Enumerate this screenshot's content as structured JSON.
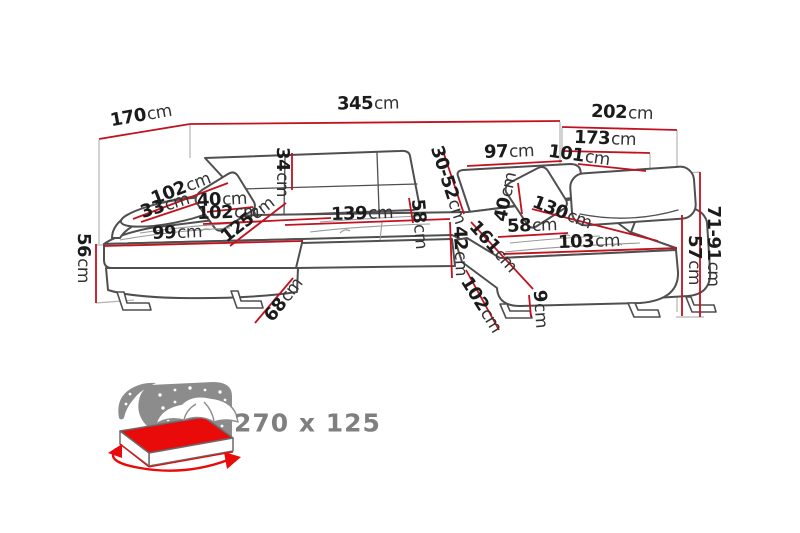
{
  "diagram": {
    "type": "corner-sofa-dimension-drawing",
    "unit": "cm",
    "dims": {
      "w170": {
        "num": "170",
        "suffix": "cm"
      },
      "w345": {
        "num": "345",
        "suffix": "cm"
      },
      "w202": {
        "num": "202",
        "suffix": "cm"
      },
      "w173": {
        "num": "173",
        "suffix": "cm"
      },
      "w97": {
        "num": "97",
        "suffix": "cm"
      },
      "w101": {
        "num": "101",
        "suffix": "cm"
      },
      "h3052": {
        "num": "30-52",
        "suffix": "cm"
      },
      "h34": {
        "num": "34",
        "suffix": "cm"
      },
      "w40l": {
        "num": "40",
        "suffix": "cm"
      },
      "w102diag": {
        "num": "102",
        "suffix": "cm"
      },
      "w33": {
        "num": "33",
        "suffix": "cm"
      },
      "w102top": {
        "num": "102",
        "suffix": "cm"
      },
      "w99": {
        "num": "99",
        "suffix": "cm"
      },
      "w125": {
        "num": "125",
        "suffix": "cm"
      },
      "w139": {
        "num": "139",
        "suffix": "cm"
      },
      "h58mid": {
        "num": "58",
        "suffix": "cm"
      },
      "h42": {
        "num": "42",
        "suffix": "cm"
      },
      "w161": {
        "num": "161",
        "suffix": "cm"
      },
      "w58r": {
        "num": "58",
        "suffix": "cm"
      },
      "w130": {
        "num": "130",
        "suffix": "cm"
      },
      "w40r": {
        "num": "40",
        "suffix": "cm"
      },
      "w103": {
        "num": "103",
        "suffix": "cm"
      },
      "w102r": {
        "num": "102",
        "suffix": "cm"
      },
      "h9": {
        "num": "9",
        "suffix": "cm"
      },
      "h68": {
        "num": "68",
        "suffix": "cm"
      },
      "h56": {
        "num": "56",
        "suffix": "cm"
      },
      "h57": {
        "num": "57",
        "suffix": "cm"
      },
      "h7191": {
        "num": "71-91",
        "suffix": "cm"
      }
    },
    "bed": {
      "size_label": "270 x 125"
    },
    "colors": {
      "dimension_line": "#c1121f",
      "sofa_outline": "#4f4f4f",
      "extension_line": "#b3b3b3",
      "label_text": "#1b1b1b",
      "icon_gray": "#8c8c8c",
      "mattress_red": "#e90a0a",
      "bed_label_gray": "#7f7f7f"
    }
  }
}
